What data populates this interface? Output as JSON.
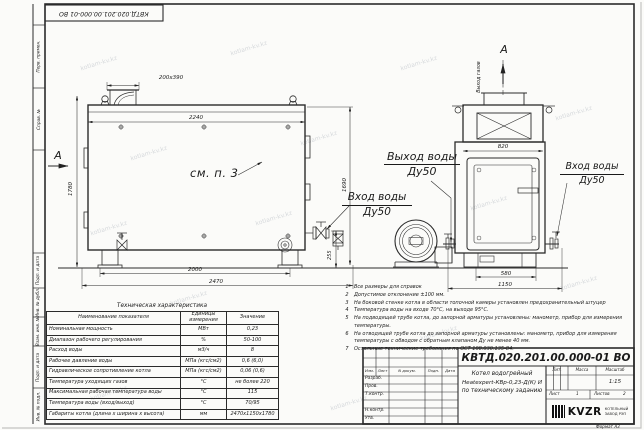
{
  "top_stamp": {
    "text": "КВТД.020.201.00.000-01 ВО"
  },
  "margin_labels": [
    "Перв. примен.",
    "Справ. №",
    "Подп. и дата",
    "Инв. № дубл.",
    "Взам. инв. №",
    "Подп. и дата",
    "Инв. № подл."
  ],
  "watermark": {
    "text": "kotlam-kv.kz"
  },
  "views": {
    "front": {
      "section_label": "А",
      "ref_note": "см. п. 3",
      "dims": {
        "chimney": "200х390",
        "top_width": "2240",
        "height_left": "1780",
        "height_right": "1690",
        "fitting_height": "255",
        "base_span": "2000",
        "overall_length": "2470"
      }
    },
    "side": {
      "section_label": "А",
      "gas_outlet_label": "Выход газов",
      "dims": {
        "top_width": "820",
        "base_span": "580",
        "overall_width": "1150"
      }
    },
    "labels": {
      "water_outlet": "Выход воды",
      "water_outlet_dn": "Ду50",
      "water_inlet": "Вход воды",
      "water_inlet_dn": "Ду50",
      "water_inlet_right": "Вход воды",
      "water_inlet_right_dn": "Ду50"
    }
  },
  "notes": {
    "items": [
      {
        "num": "1",
        "text": "Все размеры для справок"
      },
      {
        "num": "2",
        "text": "Допустимое отклонение ±100 мм."
      },
      {
        "num": "3",
        "text": "На боковой стенке котла в области топочной камеры установлен предохранительный штуцер"
      },
      {
        "num": "4",
        "text": "Температура воды на входе 70°С, на выходе 95°С."
      },
      {
        "num": "5",
        "text": "На подводящей трубе котла, до запорной арматуры установлены: манометр, прибор для измерения температуры."
      },
      {
        "num": "6",
        "text": "На отводящей трубе котла до запорной арматуры установлены: манометр, прибор для измерения температуры с обводом с обратным клапаном Ду не менее 40 мм."
      },
      {
        "num": "7",
        "text": "Остальные технические требования по ОСТ 108.030.135-84."
      }
    ]
  },
  "spec_table": {
    "title": "Техническая характеристика",
    "headers": [
      "Наименование показателя",
      "Единицы измерения",
      "Значение"
    ],
    "rows": [
      [
        "Номинальная мощность",
        "МВт",
        "0,23"
      ],
      [
        "Диапазон рабочего регулирования",
        "%",
        "50-100"
      ],
      [
        "Расход воды",
        "м3/ч",
        "8"
      ],
      [
        "Рабочее давление воды",
        "МПа (кгс/см2)",
        "0,6 (6,0)"
      ],
      [
        "Гидравлическое сопротивление котла",
        "МПа (кгс/см2)",
        "0,06 (0,6)"
      ],
      [
        "Температура уходящих газов",
        "°С",
        "не более 220"
      ],
      [
        "Максимальная рабочая температура воды",
        "°С",
        "115"
      ],
      [
        "Температура воды (вход/выход)",
        "°С",
        "70/95"
      ],
      [
        "Габариты котла (длина х ширина х высота)",
        "мм",
        "2470х1150х1780"
      ]
    ]
  },
  "title_block": {
    "doc_number": "КВТД.020.201.00.000-01 ВО",
    "name_line1": "Котел водогрейный",
    "name_line2": "Heatexpert-КВр-0,23-Д(К) И",
    "name_line3": "по техническому заданию",
    "col_headers": [
      "Изм.",
      "Лист",
      "N докум.",
      "Подп.",
      "Дата"
    ],
    "row_labels": [
      "Разраб.",
      "Пров.",
      "Т.контр.",
      "Н.контр.",
      "Утв."
    ],
    "lit_header": "Лит.",
    "mass_header": "Масса",
    "scale_header": "Масштаб",
    "scale": "1:15",
    "sheet_label": "Лист",
    "sheet_number": "1",
    "sheets_label": "Листов",
    "sheets_total": "2",
    "logo_text": "KVZR",
    "logo_caption_line1": "КОТЕЛЬНЫЙ",
    "logo_caption_line2": "ЗАВОД РЭП",
    "format_label": "Формат А3"
  }
}
